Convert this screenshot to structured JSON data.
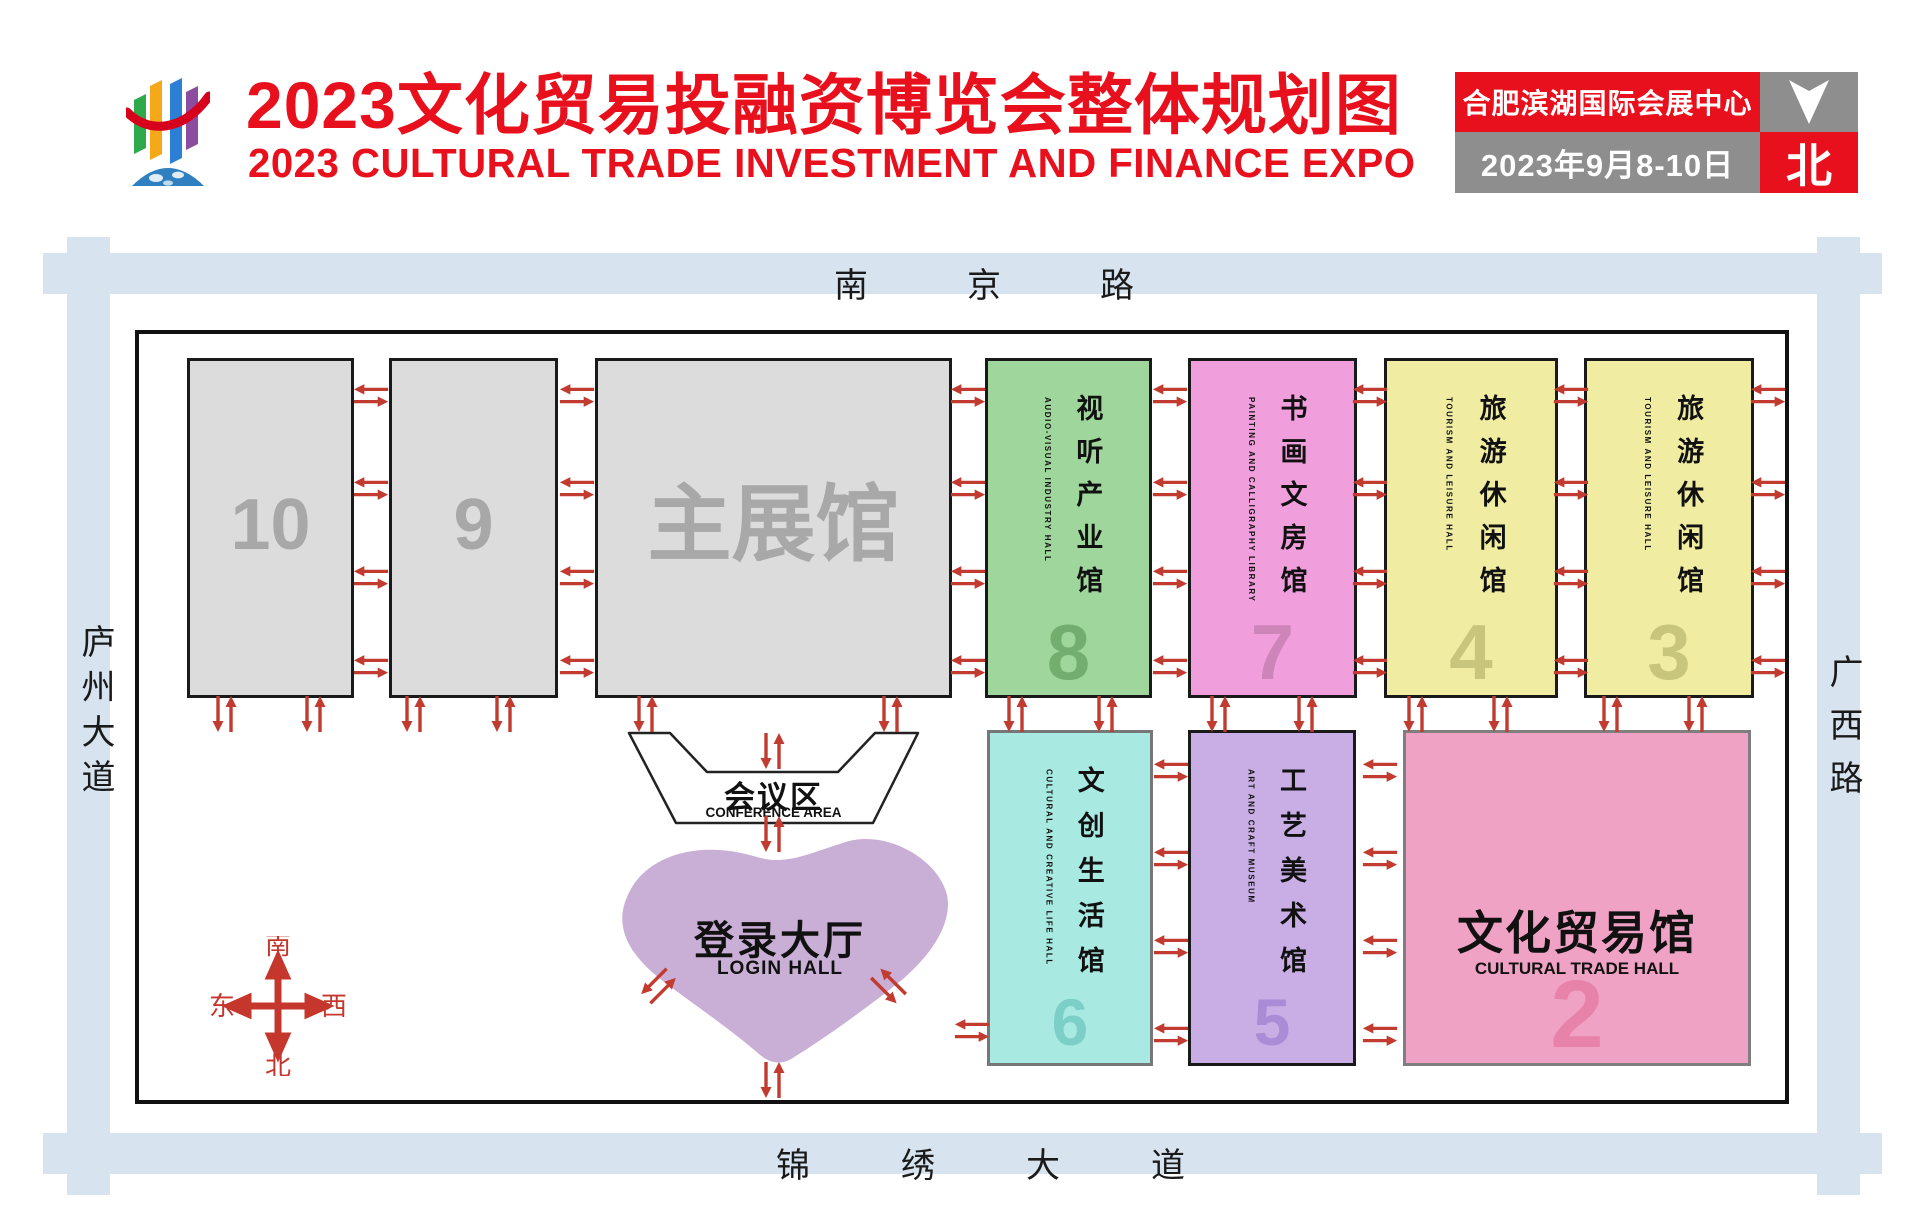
{
  "colors": {
    "accent_red": "#e8101c",
    "road_blue": "#d7e4f0",
    "arrow_red": "#c23b30",
    "hall_gray": "#dcdcdc",
    "gray_text": "#a8a8a8",
    "info_gray": "#8e8e8e"
  },
  "header": {
    "title_cn": "2023文化贸易投融资博览会整体规划图",
    "title_en": "2023 CULTURAL TRADE INVESTMENT AND FINANCE EXPO",
    "info": {
      "venue": "合肥滨湖国际会展中心",
      "dates": "2023年9月8-10日",
      "north": "北"
    }
  },
  "map": {
    "roads": {
      "top": "南京路",
      "bottom": "锦绣大道",
      "left": "庐州大道",
      "right": "广西路"
    },
    "compass": {
      "top": "南",
      "bottom": "北",
      "left": "东",
      "right": "西"
    },
    "conference": {
      "name_cn": "会议区",
      "name_en": "CONFERENCE AREA"
    },
    "login_hall": {
      "name_cn": "登录大厅",
      "name_en": "LOGIN HALL",
      "bg": "#c9afd6"
    },
    "halls": [
      {
        "id": "hall-10",
        "kind": "plain",
        "row": "top",
        "label": "10",
        "x": 187,
        "y": 358,
        "w": 167,
        "h": 340,
        "bg": "#dcdcdc",
        "border": "#1a1a1a",
        "label_color": "#a8a8a8",
        "label_size": 72
      },
      {
        "id": "hall-9",
        "kind": "plain",
        "row": "top",
        "label": "9",
        "x": 389,
        "y": 358,
        "w": 169,
        "h": 340,
        "bg": "#dcdcdc",
        "border": "#1a1a1a",
        "label_color": "#a8a8a8",
        "label_size": 72
      },
      {
        "id": "main-hall",
        "kind": "plain",
        "row": "top",
        "label": "主展馆",
        "x": 595,
        "y": 358,
        "w": 357,
        "h": 340,
        "bg": "#dcdcdc",
        "border": "#1a1a1a",
        "label_color": "#a8a8a8",
        "label_size": 84
      },
      {
        "id": "hall-8",
        "kind": "vertical",
        "row": "top",
        "number": "8",
        "name_cn": "视听产业馆",
        "name_en": "AUDIO-VISUAL INDUSTRY HALL",
        "x": 985,
        "y": 358,
        "w": 167,
        "h": 340,
        "bg": "#9fd69b",
        "border": "#1a1a1a",
        "num_color": "#74ad70"
      },
      {
        "id": "hall-7",
        "kind": "vertical",
        "row": "top",
        "number": "7",
        "name_cn": "书画文房馆",
        "name_en": "PAINTING AND CALLIGRAPHY LIBRARY",
        "x": 1188,
        "y": 358,
        "w": 169,
        "h": 340,
        "bg": "#f09edc",
        "border": "#1a1a1a",
        "num_color": "#cd85b9"
      },
      {
        "id": "hall-4",
        "kind": "vertical",
        "row": "top",
        "number": "4",
        "name_cn": "旅游休闲馆",
        "name_en": "TOURISM AND LEISURE HALL",
        "x": 1384,
        "y": 358,
        "w": 174,
        "h": 340,
        "bg": "#f0eda2",
        "border": "#1a1a1a",
        "num_color": "#c8c57c"
      },
      {
        "id": "hall-3",
        "kind": "vertical",
        "row": "top",
        "number": "3",
        "name_cn": "旅游休闲馆",
        "name_en": "TOURISM AND LEISURE HALL",
        "x": 1584,
        "y": 358,
        "w": 170,
        "h": 340,
        "bg": "#f0eda2",
        "border": "#1a1a1a",
        "num_color": "#c8c57c"
      },
      {
        "id": "hall-6",
        "kind": "vertical",
        "row": "bottom",
        "number": "6",
        "name_cn": "文创生活馆",
        "name_en": "CULTURAL AND CREATIVE LIFE HALL",
        "x": 987,
        "y": 730,
        "w": 166,
        "h": 336,
        "bg": "#a8e9e2",
        "border": "#777777",
        "num_color": "#7bcfc7"
      },
      {
        "id": "hall-5",
        "kind": "vertical",
        "row": "bottom",
        "number": "5",
        "name_cn": "工艺美术馆",
        "name_en": "ART AND CRAFT MUSEUM",
        "x": 1188,
        "y": 730,
        "w": 168,
        "h": 336,
        "bg": "#c9aee6",
        "border": "#1a1a1a",
        "num_color": "#a98bd6"
      },
      {
        "id": "hall-2",
        "kind": "horizontal",
        "row": "bottom",
        "number": "2",
        "name_cn": "文化贸易馆",
        "name_en": "CULTURAL TRADE HALL",
        "x": 1403,
        "y": 730,
        "w": 348,
        "h": 336,
        "bg": "#f0a2c4",
        "border": "#7f7f7f",
        "num_color": "#e782a8"
      }
    ],
    "arrows": [
      {
        "t": "h",
        "x": 371,
        "y": 395
      },
      {
        "t": "h",
        "x": 371,
        "y": 488
      },
      {
        "t": "h",
        "x": 371,
        "y": 577
      },
      {
        "t": "h",
        "x": 371,
        "y": 666
      },
      {
        "t": "h",
        "x": 577,
        "y": 395
      },
      {
        "t": "h",
        "x": 577,
        "y": 488
      },
      {
        "t": "h",
        "x": 577,
        "y": 577
      },
      {
        "t": "h",
        "x": 577,
        "y": 666
      },
      {
        "t": "h",
        "x": 968,
        "y": 395
      },
      {
        "t": "h",
        "x": 968,
        "y": 488
      },
      {
        "t": "h",
        "x": 968,
        "y": 577
      },
      {
        "t": "h",
        "x": 968,
        "y": 666
      },
      {
        "t": "h",
        "x": 1170,
        "y": 395
      },
      {
        "t": "h",
        "x": 1170,
        "y": 488
      },
      {
        "t": "h",
        "x": 1170,
        "y": 577
      },
      {
        "t": "h",
        "x": 1170,
        "y": 666
      },
      {
        "t": "h",
        "x": 1370,
        "y": 395
      },
      {
        "t": "h",
        "x": 1370,
        "y": 488
      },
      {
        "t": "h",
        "x": 1370,
        "y": 577
      },
      {
        "t": "h",
        "x": 1370,
        "y": 666
      },
      {
        "t": "h",
        "x": 1571,
        "y": 395
      },
      {
        "t": "h",
        "x": 1571,
        "y": 488
      },
      {
        "t": "h",
        "x": 1571,
        "y": 577
      },
      {
        "t": "h",
        "x": 1571,
        "y": 666
      },
      {
        "t": "h",
        "x": 1768,
        "y": 395
      },
      {
        "t": "h",
        "x": 1768,
        "y": 488
      },
      {
        "t": "h",
        "x": 1768,
        "y": 577
      },
      {
        "t": "h",
        "x": 1768,
        "y": 666
      },
      {
        "t": "h",
        "x": 1171,
        "y": 770
      },
      {
        "t": "h",
        "x": 1171,
        "y": 858
      },
      {
        "t": "h",
        "x": 1171,
        "y": 946
      },
      {
        "t": "h",
        "x": 1171,
        "y": 1034
      },
      {
        "t": "h",
        "x": 1380,
        "y": 770
      },
      {
        "t": "h",
        "x": 1380,
        "y": 858
      },
      {
        "t": "h",
        "x": 1380,
        "y": 946
      },
      {
        "t": "h",
        "x": 1380,
        "y": 1034
      },
      {
        "t": "h",
        "x": 972,
        "y": 1030
      },
      {
        "t": "v",
        "x": 224,
        "y": 714
      },
      {
        "t": "v",
        "x": 313,
        "y": 714
      },
      {
        "t": "v",
        "x": 413,
        "y": 714
      },
      {
        "t": "v",
        "x": 503,
        "y": 714
      },
      {
        "t": "v",
        "x": 645,
        "y": 714
      },
      {
        "t": "v",
        "x": 890,
        "y": 714
      },
      {
        "t": "v",
        "x": 1015,
        "y": 714
      },
      {
        "t": "v",
        "x": 1105,
        "y": 714
      },
      {
        "t": "v",
        "x": 1218,
        "y": 714
      },
      {
        "t": "v",
        "x": 1305,
        "y": 714
      },
      {
        "t": "v",
        "x": 1415,
        "y": 714
      },
      {
        "t": "v",
        "x": 1500,
        "y": 714
      },
      {
        "t": "v",
        "x": 1610,
        "y": 714
      },
      {
        "t": "v",
        "x": 1695,
        "y": 714
      },
      {
        "t": "v",
        "x": 772,
        "y": 751
      },
      {
        "t": "v",
        "x": 772,
        "y": 834
      },
      {
        "t": "v",
        "x": 772,
        "y": 1080
      },
      {
        "t": "v",
        "x": 658,
        "y": 986,
        "a": 45
      },
      {
        "t": "v",
        "x": 888,
        "y": 986,
        "a": -45
      }
    ]
  }
}
